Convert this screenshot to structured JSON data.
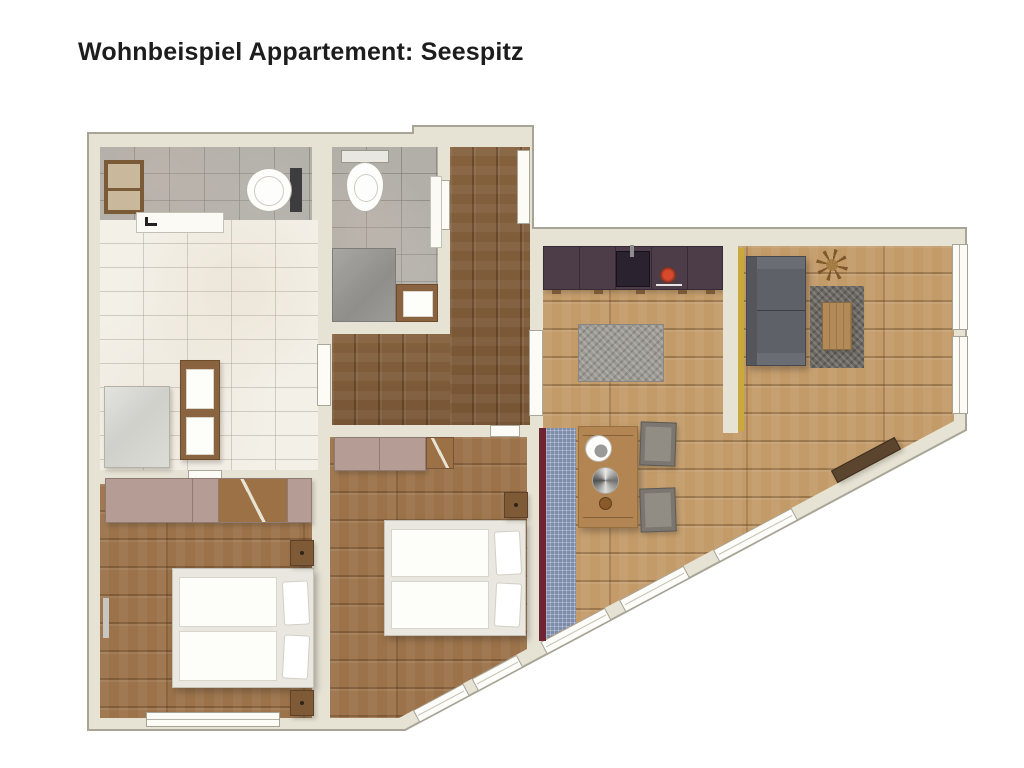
{
  "title": "Wohnbeispiel Appartement: Seespitz",
  "colors": {
    "wall": "#e6e3d5",
    "wall_line": "#a8a597",
    "floor_light": "#c39b69",
    "floor_bed": "#9b7249",
    "floor_hall": "#8d6843",
    "kitchen_cabinet": "#4c3d48",
    "accent_yellow": "#c9a93c",
    "accent_maroon": "#6d2533",
    "rug_blue": "#7d8cab",
    "mauve": "#b59d96",
    "sofa": "#5f6168",
    "wood_furn": "#8a6440",
    "white_fix": "#fbfaf5"
  },
  "icons": {
    "toilet": "white oval bowl with cistern",
    "shower": "glass square",
    "washbasin_unit": "wood cabinet with two white basins",
    "bed_double": "white frame, two mattresses, two pillows",
    "wardrobe": "mauve block with open wood door",
    "kitchen_counter": "dark aubergine run with sink and red cooktop",
    "sofa": "dark gray three-seater",
    "dining_table": "wood table with plates and plant",
    "chair": "gray square seat",
    "rug": "gray / blue checkered textiles",
    "plant": "brown starburst top view",
    "window": "white frame in wall",
    "door": "white leaf"
  }
}
